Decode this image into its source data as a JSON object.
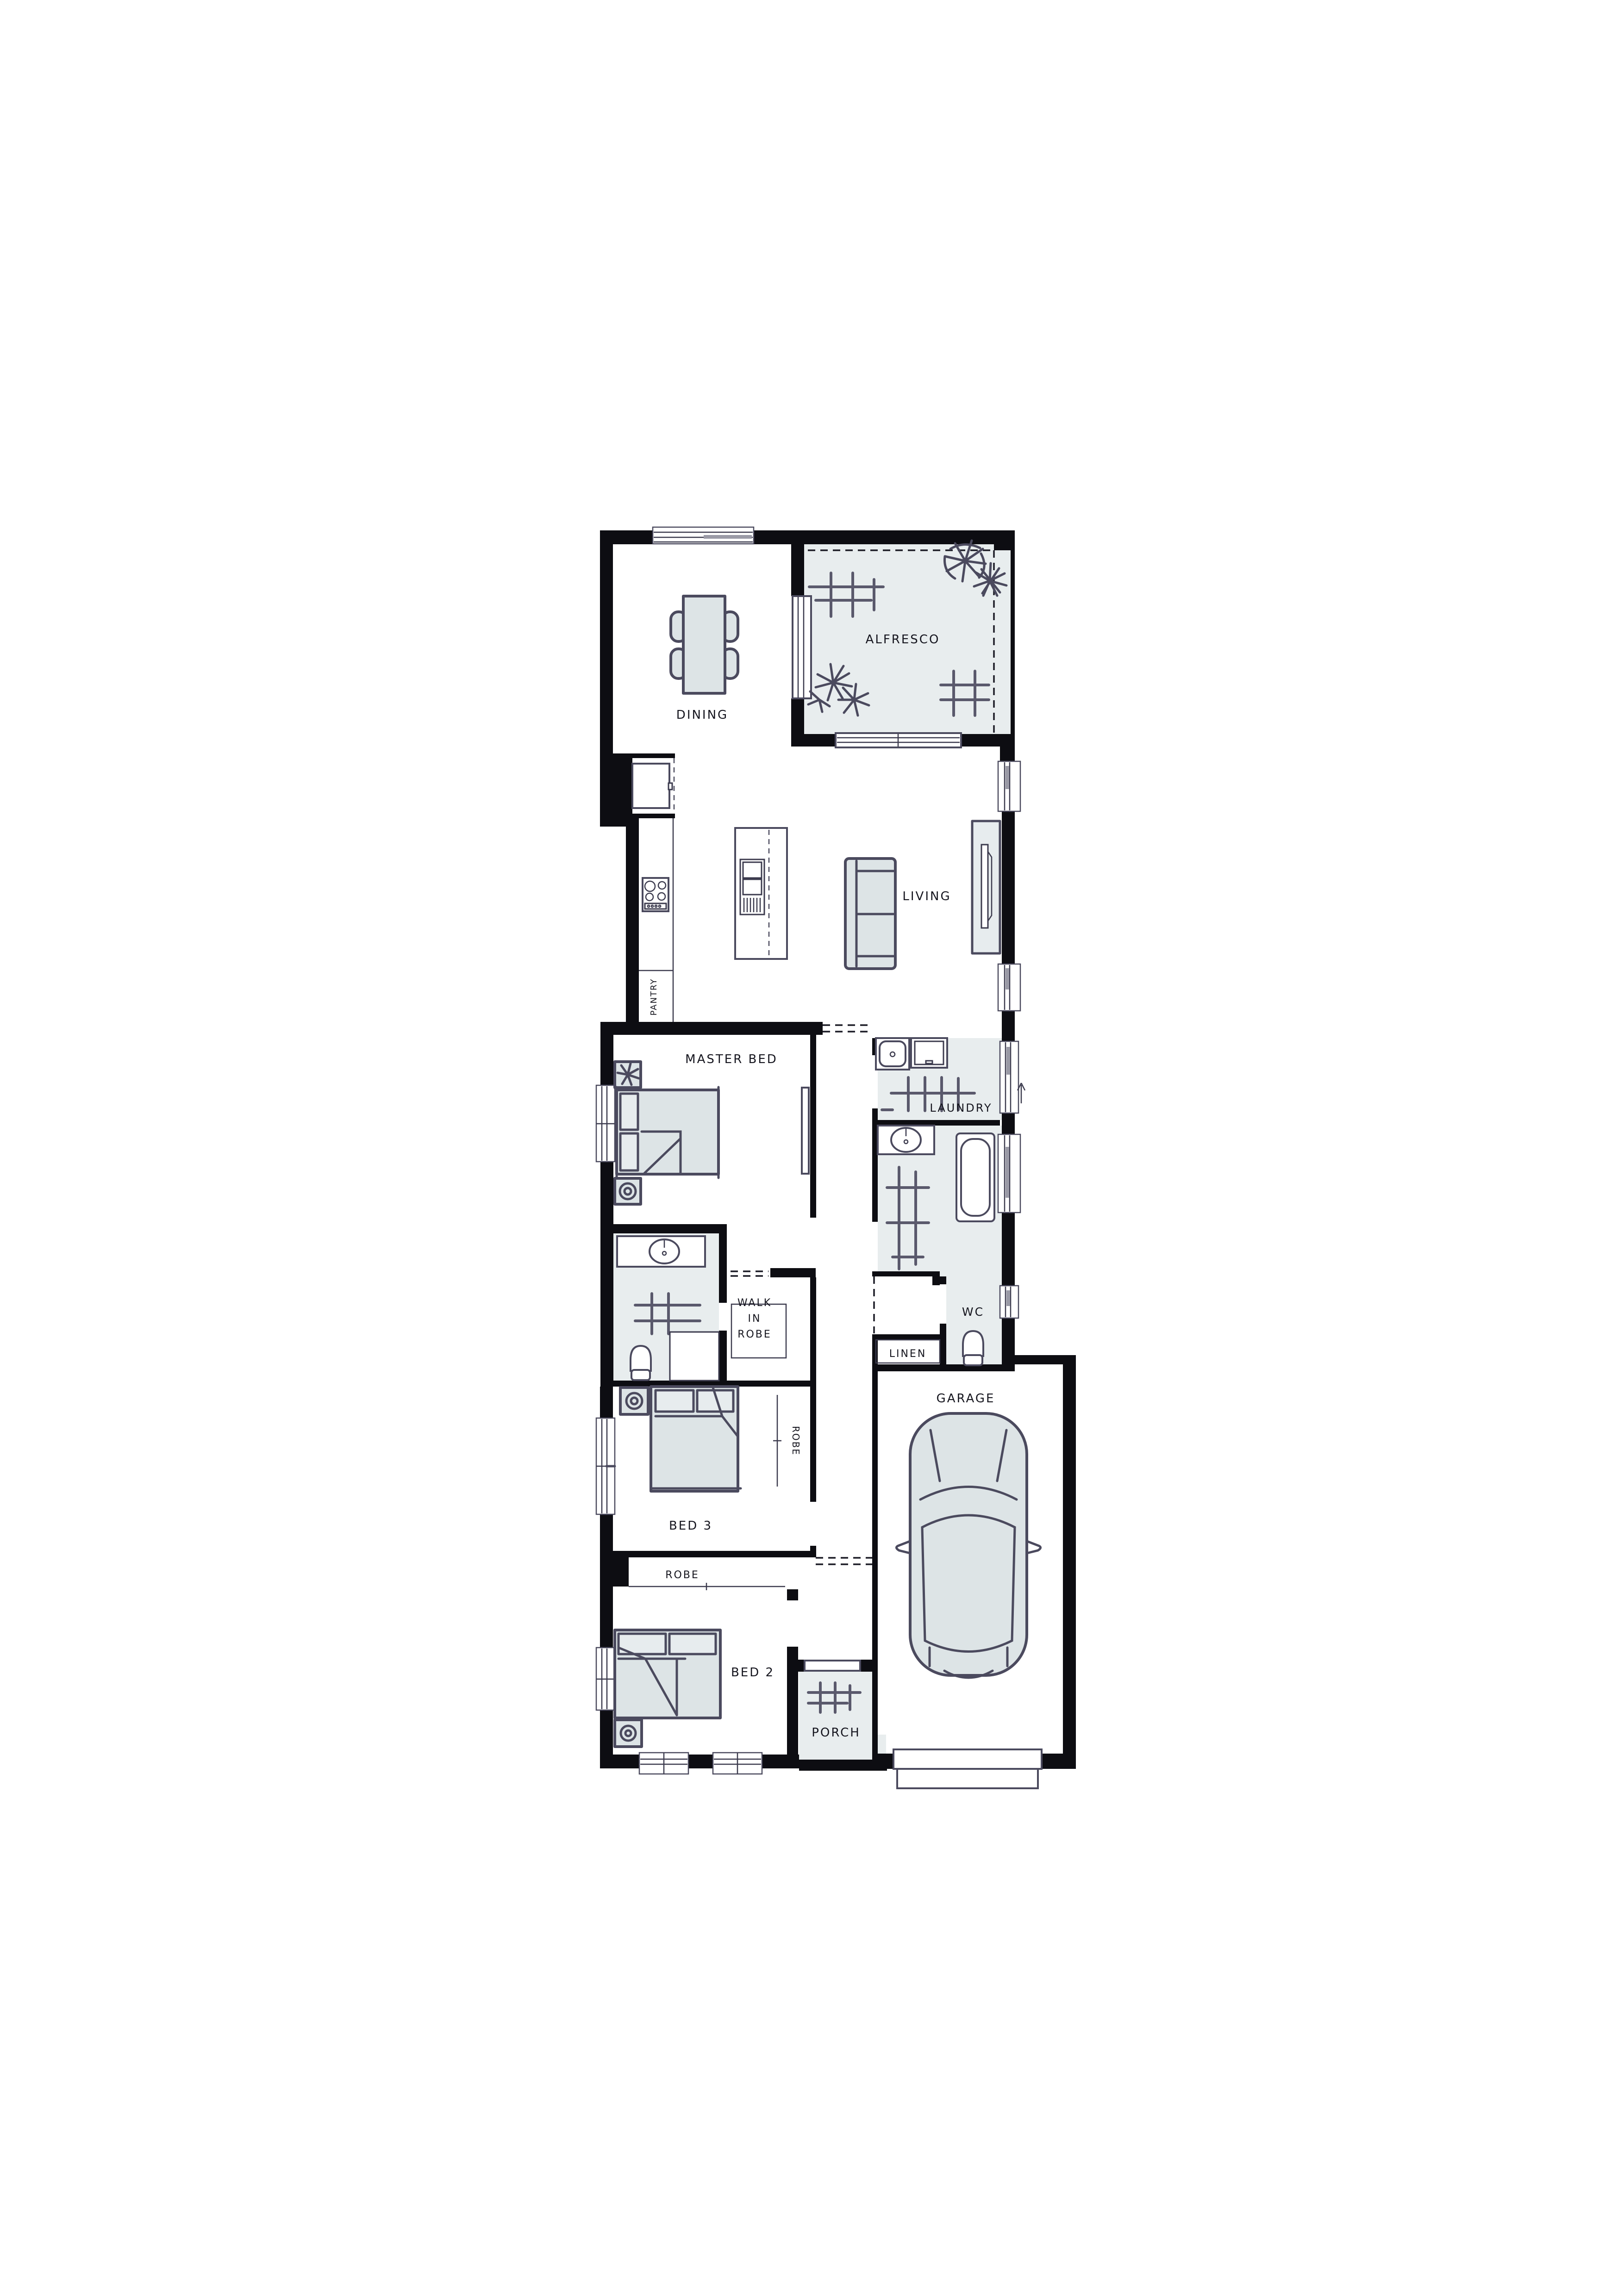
{
  "drawing": {
    "type": "residential floor plan",
    "palette": {
      "paper": "#ffffff",
      "wall": "#0d0d12",
      "sketch_line": "#4b4a5e",
      "room_fill": "#e8edee",
      "furniture_fill": "#dde4e6",
      "text": "#15151e"
    }
  },
  "rooms": {
    "dining": {
      "label": "DINING"
    },
    "alfresco": {
      "label": "ALFRESCO"
    },
    "living": {
      "label": "LIVING"
    },
    "pantry": {
      "label": "PANTRY"
    },
    "master_bed": {
      "label": "MASTER BED"
    },
    "laundry": {
      "label": "LAUNDRY"
    },
    "walk_in_robe": {
      "label_lines": [
        "WALK",
        "IN",
        "ROBE"
      ]
    },
    "wc": {
      "label": "WC"
    },
    "linen": {
      "label": "LINEN"
    },
    "garage": {
      "label": "GARAGE"
    },
    "bed3": {
      "label": "BED 3"
    },
    "robe_bed3": {
      "label": "ROBE"
    },
    "robe_bed2": {
      "label": "ROBE"
    },
    "bed2": {
      "label": "BED 2"
    },
    "porch": {
      "label": "PORCH"
    }
  }
}
